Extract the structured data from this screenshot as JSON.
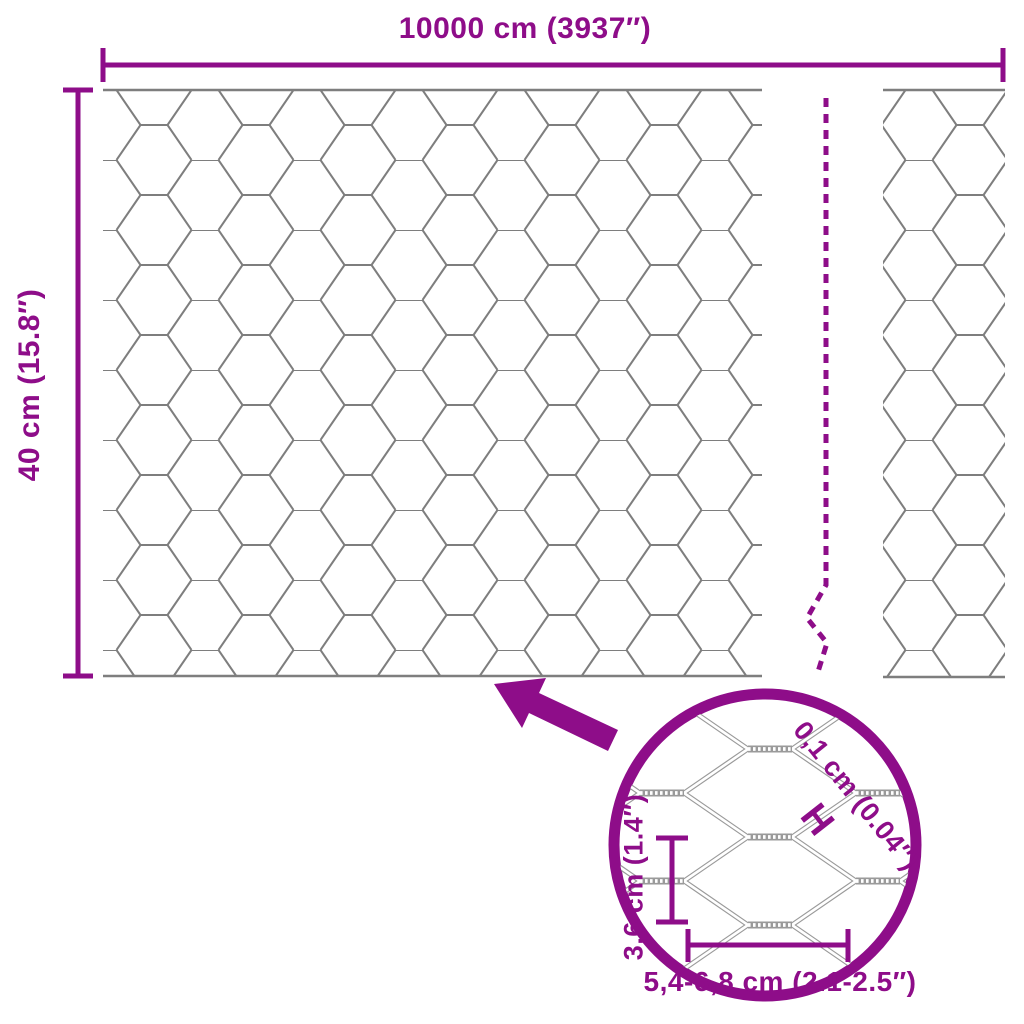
{
  "colors": {
    "accent": "#8E0D89",
    "mesh_line": "#7E7E7E",
    "closeup_wire": "#9A9A9A",
    "background": "#FFFFFF"
  },
  "overall_dimensions": {
    "width_label": "10000 cm (3937″)",
    "height_label": "40 cm (15.8″)"
  },
  "detail_view": {
    "wire_thickness_label": "0,1 cm (0.04″)",
    "wire_thickness_symbol": "H",
    "mesh_height_label": "3,6 cm (1.4″)",
    "mesh_width_label": "5,4-6,8 cm (2.1-2.5″)"
  },
  "icons": {
    "zoom_arrow": "thick-arrow-pointing-up-left",
    "magnifier_circle": "detail-zoom-circle",
    "continuation_line": "dashed-break-line"
  }
}
